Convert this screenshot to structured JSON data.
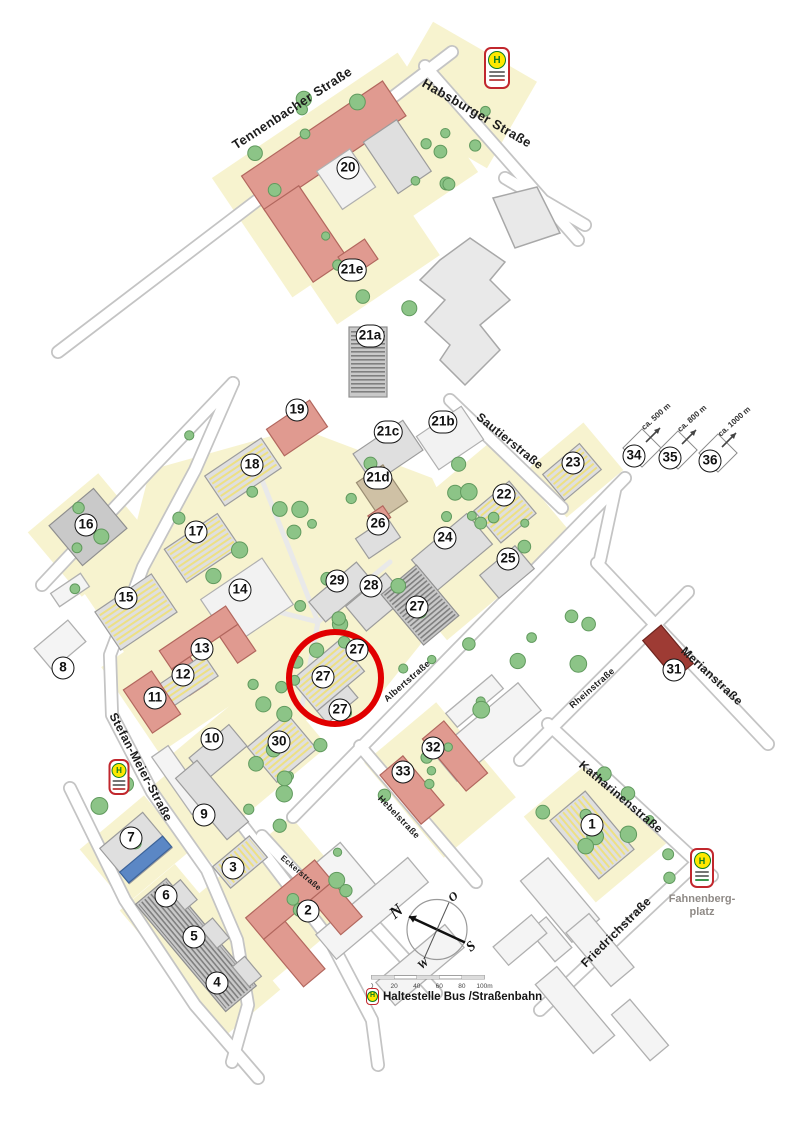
{
  "map": {
    "colors": {
      "highlight": "#e10000",
      "stop_frame": "#c1272d",
      "stop_circle_fill": "#ffe800",
      "stop_h_green": "#0b7c22",
      "tree_green": "#8cc487",
      "parcel_yellow": "#f7f3cf",
      "roof_red": "#e09a90",
      "building_gray": "#dfdfdf"
    },
    "street_labels": [
      {
        "id": "tennenbacher-strasse",
        "name": "Tennenbacher Straße",
        "x": 292,
        "y": 108,
        "rot": -33,
        "size": 13
      },
      {
        "id": "habsburger-strasse",
        "name": "Habsburger Straße",
        "x": 477,
        "y": 113,
        "rot": 30,
        "size": 13
      },
      {
        "id": "sautierstrasse",
        "name": "Sautierstraße",
        "x": 510,
        "y": 441,
        "rot": 39,
        "size": 12
      },
      {
        "id": "stefan-meier-strasse",
        "name": "Stefan-Meier-Straße",
        "x": 141,
        "y": 767,
        "rot": 62,
        "size": 12
      },
      {
        "id": "albertstrasse",
        "name": "Albertstraße",
        "x": 407,
        "y": 681,
        "rot": -41,
        "size": 9
      },
      {
        "id": "hebelstrasse",
        "name": "Hebelstraße",
        "x": 399,
        "y": 817,
        "rot": 46,
        "size": 9
      },
      {
        "id": "merianstrasse",
        "name": "Merianstraße",
        "x": 712,
        "y": 676,
        "rot": 43,
        "size": 12
      },
      {
        "id": "rheinstrasse",
        "name": "Rheinstraße",
        "x": 592,
        "y": 688,
        "rot": -41,
        "size": 9
      },
      {
        "id": "katharinenstrasse",
        "name": "Katharinenstraße",
        "x": 621,
        "y": 797,
        "rot": 40,
        "size": 12
      },
      {
        "id": "friedrichstrasse",
        "name": "Friedrichstraße",
        "x": 616,
        "y": 932,
        "rot": -45,
        "size": 12
      },
      {
        "id": "eckerstrasse",
        "name": "Eckerstraße",
        "x": 301,
        "y": 873,
        "rot": 40,
        "size": 8
      }
    ],
    "building_markers": [
      {
        "label": "1",
        "x": 592,
        "y": 825
      },
      {
        "label": "2",
        "x": 308,
        "y": 911
      },
      {
        "label": "3",
        "x": 233,
        "y": 868
      },
      {
        "label": "4",
        "x": 217,
        "y": 983
      },
      {
        "label": "5",
        "x": 194,
        "y": 937
      },
      {
        "label": "6",
        "x": 166,
        "y": 896
      },
      {
        "label": "7",
        "x": 131,
        "y": 838
      },
      {
        "label": "8",
        "x": 63,
        "y": 668
      },
      {
        "label": "9",
        "x": 204,
        "y": 815
      },
      {
        "label": "10",
        "x": 212,
        "y": 739
      },
      {
        "label": "11",
        "x": 155,
        "y": 698
      },
      {
        "label": "12",
        "x": 183,
        "y": 675
      },
      {
        "label": "13",
        "x": 202,
        "y": 649
      },
      {
        "label": "14",
        "x": 240,
        "y": 590
      },
      {
        "label": "15",
        "x": 126,
        "y": 598
      },
      {
        "label": "16",
        "x": 86,
        "y": 525
      },
      {
        "label": "17",
        "x": 196,
        "y": 532
      },
      {
        "label": "18",
        "x": 252,
        "y": 465
      },
      {
        "label": "19",
        "x": 297,
        "y": 410
      },
      {
        "label": "20",
        "x": 348,
        "y": 168
      },
      {
        "label": "21a",
        "x": 370,
        "y": 336
      },
      {
        "label": "21b",
        "x": 443,
        "y": 422
      },
      {
        "label": "21c",
        "x": 388,
        "y": 432
      },
      {
        "label": "21d",
        "x": 378,
        "y": 478
      },
      {
        "label": "21e",
        "x": 352,
        "y": 270
      },
      {
        "label": "22",
        "x": 504,
        "y": 495
      },
      {
        "label": "23",
        "x": 573,
        "y": 463
      },
      {
        "label": "24",
        "x": 445,
        "y": 538
      },
      {
        "label": "25",
        "x": 508,
        "y": 559
      },
      {
        "label": "26",
        "x": 378,
        "y": 524
      },
      {
        "label": "27",
        "x": 417,
        "y": 607
      },
      {
        "label": "27",
        "x": 357,
        "y": 650
      },
      {
        "label": "27",
        "x": 323,
        "y": 677
      },
      {
        "label": "27",
        "x": 340,
        "y": 710
      },
      {
        "label": "28",
        "x": 371,
        "y": 586
      },
      {
        "label": "29",
        "x": 337,
        "y": 581
      },
      {
        "label": "30",
        "x": 279,
        "y": 742
      },
      {
        "label": "31",
        "x": 674,
        "y": 670
      },
      {
        "label": "32",
        "x": 433,
        "y": 748
      },
      {
        "label": "33",
        "x": 403,
        "y": 772
      }
    ],
    "distance_markers": [
      {
        "label": "34",
        "distance": "ca. 500 m",
        "x": 634,
        "y": 456
      },
      {
        "label": "35",
        "distance": "ca. 800 m",
        "x": 670,
        "y": 458
      },
      {
        "label": "36",
        "distance": "ca. 1000 m",
        "x": 710,
        "y": 461
      }
    ],
    "highlight_circle": {
      "x": 335,
      "y": 678,
      "r": 49
    },
    "stops": [
      {
        "id": "stop-habsburger",
        "x": 497,
        "y": 68,
        "w": 26,
        "h": 42
      },
      {
        "id": "stop-stefan-meier",
        "x": 119,
        "y": 777,
        "w": 21,
        "h": 36
      },
      {
        "id": "stop-fahnenbergplatz",
        "x": 702,
        "y": 868,
        "w": 24,
        "h": 40
      }
    ],
    "stop_h_glyph": "H",
    "stop_caption_lines": [
      "Fahnenberg-",
      "platz"
    ],
    "compass": {
      "x": 437,
      "y": 932,
      "n": "N",
      "o": "O",
      "s": "S",
      "w": "W"
    },
    "scale_bar": {
      "x": 371,
      "y": 975,
      "width": 113,
      "ticks": [
        "0",
        "20",
        "40",
        "60",
        "80",
        "100m"
      ]
    },
    "legend": {
      "x": 366,
      "y": 988,
      "label": "Haltestelle Bus /Straßenbahn"
    }
  }
}
